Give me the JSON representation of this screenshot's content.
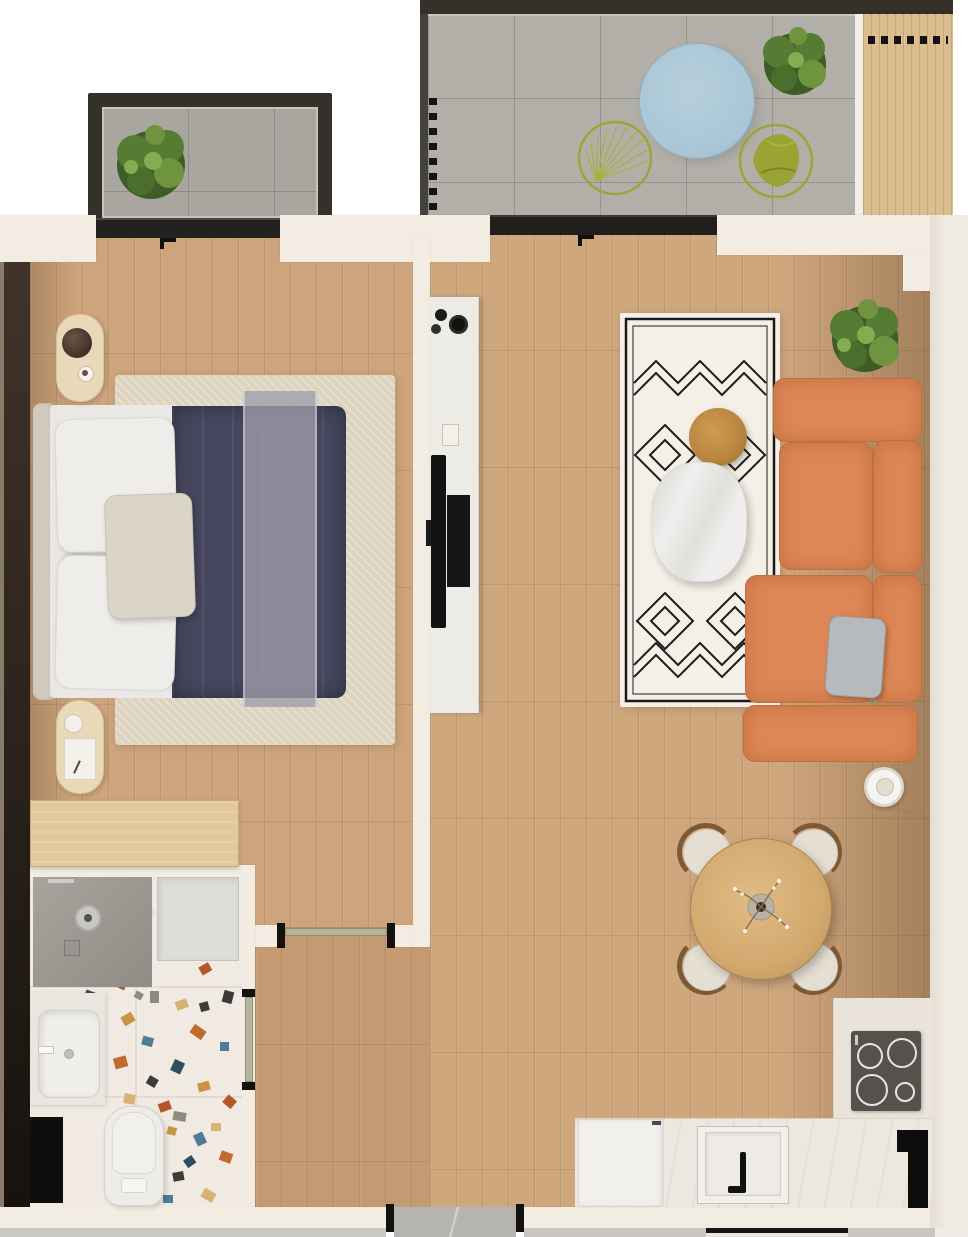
{
  "scene": {
    "type": "apartment-floor-plan-top-view",
    "rooms": [
      {
        "name": "balcony-small",
        "items": [
          "tile-floor",
          "green-bush-plant",
          "sliding-window"
        ]
      },
      {
        "name": "terrace-large",
        "items": [
          "tile-floor",
          "round-blue-outdoor-rug",
          "wire-lounge-chair",
          "green-lounge-chair",
          "outdoor-plant",
          "wood-deck-screen",
          "louver-slats",
          "sliding-door"
        ]
      },
      {
        "name": "bedroom",
        "items": [
          "double-bed",
          "navy-duvet",
          "sheer-gray-throw",
          "white-pillows",
          "accent-pillow",
          "beige-area-rug",
          "nightstand-top",
          "nightstand-bottom",
          "dark-wardrobe-wall",
          "wood-desk",
          "window"
        ]
      },
      {
        "name": "living-room",
        "items": [
          "orange-sectional-sofa",
          "gray-cushion",
          "geometric-pattern-rug",
          "marble-coffee-table",
          "round-wood-side-table",
          "tv-console",
          "tv",
          "media-box",
          "decor-vases",
          "potted-plant",
          "floor-lamp"
        ]
      },
      {
        "name": "dining-area",
        "items": [
          "round-wood-table",
          "flower-vase",
          "dining-chair-1",
          "dining-chair-2",
          "dining-chair-3",
          "dining-chair-4"
        ]
      },
      {
        "name": "kitchen",
        "items": [
          "l-shaped-counter",
          "induction-cooktop",
          "sink",
          "black-faucet",
          "refrigerator",
          "tall-black-unit"
        ]
      },
      {
        "name": "bathroom",
        "items": [
          "walk-in-shower",
          "shower-head",
          "shower-glass",
          "shower-tray",
          "vanity-sink",
          "toilet",
          "terrazzo-floor",
          "dark-floor-mat"
        ]
      },
      {
        "name": "hallway",
        "items": [
          "entrance-door-opening",
          "bedroom-door-sage",
          "bathroom-door-sage",
          "entry-tile"
        ]
      }
    ]
  },
  "palette": {
    "wall": "#f2ece2",
    "wallshadow": "#e3dacc",
    "woodbed": "#cda47b",
    "woodliving": "#cfa77d",
    "woodcorridor": "#c39a71",
    "framedark": "#34312b",
    "windowblack": "#232220",
    "tilebalcony": "#a9a6a0",
    "tileterrace": "#b2afa9",
    "tileentry": "#b6b4b0",
    "terrazzobase": "#f0eae3",
    "navy": "#46465f",
    "throwgray": "rgba(158,158,172,0.78)",
    "pillowwhite": "#efedea",
    "bedrug": "#ddd3be",
    "orange": "#dd8757",
    "orangedark": "#c06f3e",
    "rugcream": "#f4f0e7",
    "rugline": "#1b1b1b",
    "marble": "#f1efed",
    "sidetablewood": "#b8853e",
    "deskwood": "#e3c89a",
    "tablewood": "#d2a96f",
    "chaircushion": "#e5dfd3",
    "chairwood": "#7d5a35",
    "greendark": "#3e5c28",
    "greenmid": "#567c33",
    "greenlight": "#6f9440",
    "chairgreen": "#9aa334",
    "blueround": "#a9c6d6",
    "sage": "#b7b69c",
    "counter": "#ece7df",
    "cooktop": "#55524d",
    "woodpanel": "#dcbd90",
    "wardrobe1": "#40342a",
    "wardrobe2": "#17120e"
  }
}
